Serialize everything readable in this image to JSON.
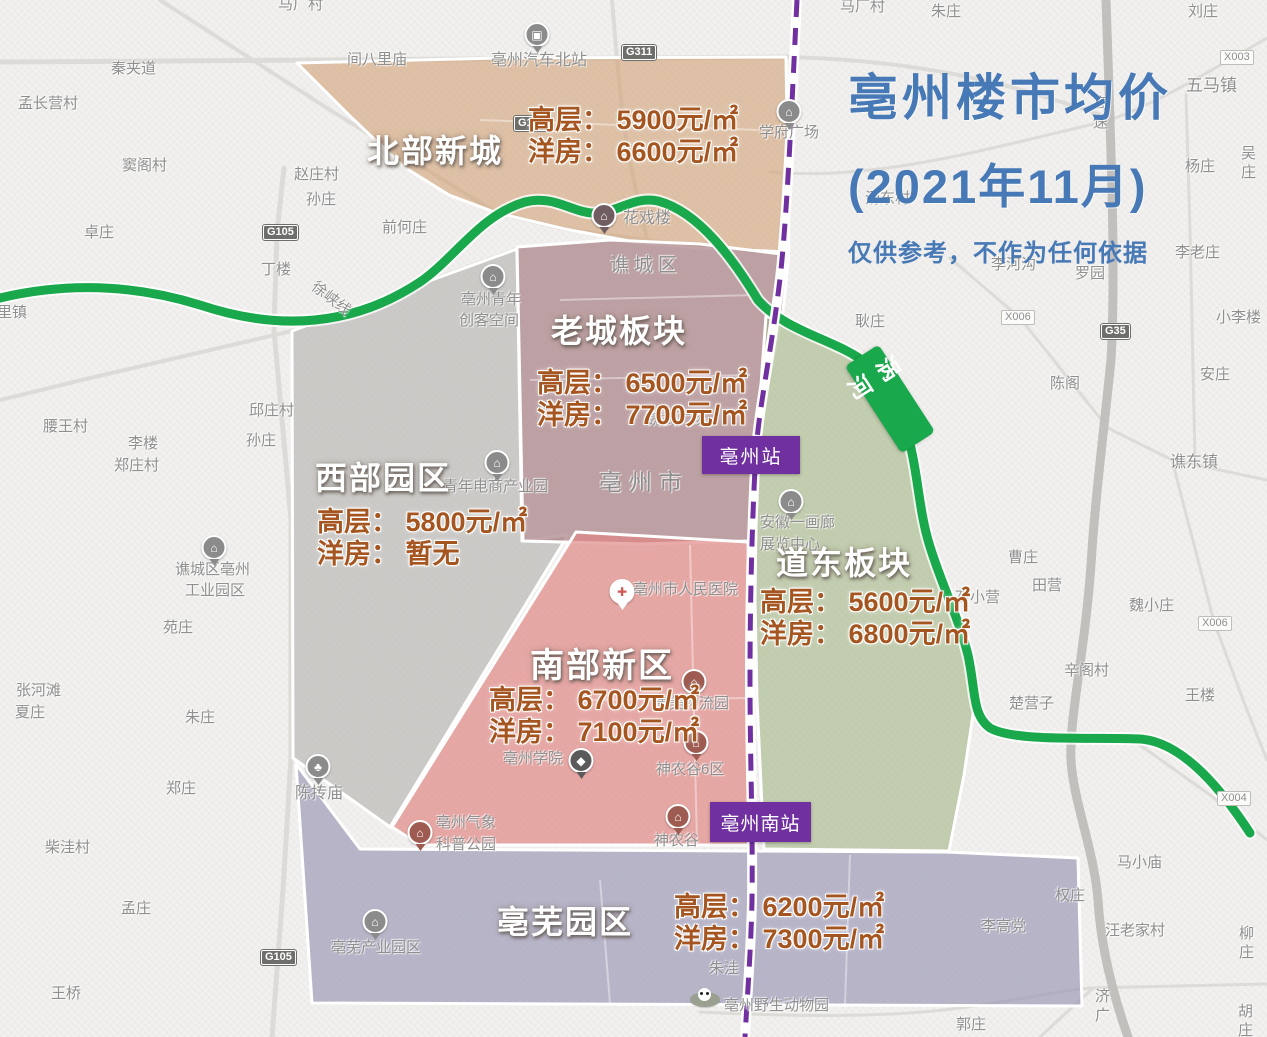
{
  "title": {
    "line1": "亳州楼市均价",
    "line2": "(2021年11月)",
    "disclaimer": "仅供参考，不作为任何依据"
  },
  "price_regions": [
    {
      "name": "北部新城",
      "rows": [
        "高层： 5900元/㎡",
        "洋房： 6600元/㎡"
      ]
    },
    {
      "name": "老城板块",
      "rows": [
        "高层： 6500元/㎡",
        "洋房： 7700元/㎡"
      ]
    },
    {
      "name": "西部园区",
      "rows": [
        "高层： 5800元/㎡",
        "洋房： 暂无"
      ]
    },
    {
      "name": "道东板块",
      "rows": [
        "高层： 5600元/㎡",
        "洋房： 6800元/㎡"
      ]
    },
    {
      "name": "南部新区",
      "rows": [
        "高层： 6700元/㎡",
        "洋房： 7100元/㎡"
      ]
    },
    {
      "name": "亳芜园区",
      "rows": [
        "高层： 6200元/㎡",
        "洋房： 7300元/㎡"
      ]
    }
  ],
  "stations": [
    {
      "label": "亳州站"
    },
    {
      "label": "亳州南站"
    }
  ],
  "river_label": "涡河",
  "colors": {
    "title": "#4679b5",
    "price_text": "#a5551f",
    "river": "#1aa84c",
    "railway": "#7030a0",
    "station_bg": "#7030a0",
    "region_north": "#d2a379",
    "region_old": "#a98287",
    "region_west": "#b2b0ae",
    "region_east": "#a3b685",
    "region_south": "#e08581",
    "region_bowu": "#9a97b5"
  },
  "map_labels": [
    {
      "t": "马厂村",
      "x": 278,
      "y": -4
    },
    {
      "t": "马厂村",
      "x": 840,
      "y": -2
    },
    {
      "t": "孟长营村",
      "x": 18,
      "y": 95
    },
    {
      "t": "秦夹道",
      "x": 111,
      "y": 60
    },
    {
      "t": "窦阁村",
      "x": 122,
      "y": 157
    },
    {
      "t": "卓庄",
      "x": 84,
      "y": 224
    },
    {
      "t": "里镇",
      "x": -3,
      "y": 304
    },
    {
      "t": "丁楼",
      "x": 261,
      "y": 261
    },
    {
      "t": "赵庄村",
      "x": 294,
      "y": 166
    },
    {
      "t": "孙庄",
      "x": 306,
      "y": 191
    },
    {
      "t": "前何庄",
      "x": 382,
      "y": 219
    },
    {
      "t": "间八里庙",
      "x": 347,
      "y": 51
    },
    {
      "t": "亳州汽车北站",
      "x": 491,
      "y": 51,
      "s": 16
    },
    {
      "t": "学府广场",
      "x": 759,
      "y": 124
    },
    {
      "t": "朱庄",
      "x": 931,
      "y": 3
    },
    {
      "t": "刘庄",
      "x": 1188,
      "y": 3
    },
    {
      "t": "五马镇",
      "x": 1186,
      "y": 75,
      "s": 17
    },
    {
      "t": "吴庄",
      "x": 1241,
      "y": 145
    },
    {
      "t": "杨庄",
      "x": 1185,
      "y": 158
    },
    {
      "t": "汤东村",
      "x": 865,
      "y": 190
    },
    {
      "t": "高速",
      "x": 1093,
      "y": 95,
      "vert": 1
    },
    {
      "t": "李老庄",
      "x": 1175,
      "y": 244
    },
    {
      "t": "李河沟",
      "x": 991,
      "y": 256
    },
    {
      "t": "罗园",
      "x": 1075,
      "y": 265
    },
    {
      "t": "小李楼",
      "x": 1216,
      "y": 309
    },
    {
      "t": "陈阁",
      "x": 1050,
      "y": 375
    },
    {
      "t": "安庄",
      "x": 1200,
      "y": 366
    },
    {
      "t": "谯东镇",
      "x": 1170,
      "y": 453,
      "s": 16
    },
    {
      "t": "耿庄",
      "x": 855,
      "y": 313
    },
    {
      "t": "花戏楼",
      "x": 623,
      "y": 209,
      "s": 16
    },
    {
      "t": "谯城区",
      "x": 610,
      "y": 254,
      "s": 19,
      "ls": 5
    },
    {
      "t": "亳州青年",
      "x": 461,
      "y": 291
    },
    {
      "t": "创客空间",
      "x": 459,
      "y": 312
    },
    {
      "t": "徐峡线",
      "x": 308,
      "y": 290,
      "rot": 38
    },
    {
      "t": "邱庄村",
      "x": 249,
      "y": 402
    },
    {
      "t": "孙庄",
      "x": 246,
      "y": 432
    },
    {
      "t": "腰王村",
      "x": 43,
      "y": 418
    },
    {
      "t": "李楼",
      "x": 128,
      "y": 435
    },
    {
      "t": "郑庄村",
      "x": 114,
      "y": 457
    },
    {
      "t": "青年电商产业园",
      "x": 443,
      "y": 478,
      "s": 15
    },
    {
      "t": "亳州市",
      "x": 599,
      "y": 468,
      "s": 23,
      "ls": 7,
      "c": "#8b8b8b"
    },
    {
      "t": "魏武广场",
      "x": 646,
      "y": 411,
      "s": 15
    },
    {
      "t": "安徽一画廊",
      "x": 760,
      "y": 514
    },
    {
      "t": "展览中心",
      "x": 760,
      "y": 536
    },
    {
      "t": "谯城区亳州",
      "x": 175,
      "y": 561
    },
    {
      "t": "工业园区",
      "x": 185,
      "y": 582
    },
    {
      "t": "苑庄",
      "x": 163,
      "y": 619
    },
    {
      "t": "亳州市人民医院",
      "x": 633,
      "y": 581,
      "s": 15
    },
    {
      "t": "康美物流园",
      "x": 654,
      "y": 695
    },
    {
      "t": "亳州学院",
      "x": 503,
      "y": 750
    },
    {
      "t": "神农谷6区",
      "x": 656,
      "y": 761
    },
    {
      "t": "神农谷",
      "x": 654,
      "y": 832
    },
    {
      "t": "亳州气象",
      "x": 436,
      "y": 814
    },
    {
      "t": "科普公园",
      "x": 436,
      "y": 836
    },
    {
      "t": "陈抟庙",
      "x": 295,
      "y": 784,
      "s": 16
    },
    {
      "t": "亳芜产业园区",
      "x": 331,
      "y": 939
    },
    {
      "t": "朱洼",
      "x": 709,
      "y": 960
    },
    {
      "t": "李高党",
      "x": 981,
      "y": 918
    },
    {
      "t": "亳州南站",
      "x": 744,
      "y": 811
    },
    {
      "t": "亳州野生动物园",
      "x": 724,
      "y": 997,
      "s": 15
    },
    {
      "t": "郭庄",
      "x": 956,
      "y": 1016
    },
    {
      "t": "胡庄",
      "x": 1238,
      "y": 1003
    },
    {
      "t": "济广",
      "x": 1095,
      "y": 988,
      "vert": 1
    },
    {
      "t": "张河滩",
      "x": 16,
      "y": 682
    },
    {
      "t": "夏庄",
      "x": 15,
      "y": 704
    },
    {
      "t": "朱庄",
      "x": 185,
      "y": 709
    },
    {
      "t": "郑庄",
      "x": 166,
      "y": 780
    },
    {
      "t": "柴洼村",
      "x": 45,
      "y": 839
    },
    {
      "t": "孟庄",
      "x": 121,
      "y": 900
    },
    {
      "t": "王桥",
      "x": 51,
      "y": 985
    },
    {
      "t": "曹庄",
      "x": 1008,
      "y": 549
    },
    {
      "t": "田营",
      "x": 1032,
      "y": 577
    },
    {
      "t": "石小营",
      "x": 955,
      "y": 589
    },
    {
      "t": "魏小庄",
      "x": 1129,
      "y": 597
    },
    {
      "t": "辛阁村",
      "x": 1064,
      "y": 662
    },
    {
      "t": "王楼",
      "x": 1185,
      "y": 687
    },
    {
      "t": "楚营子",
      "x": 1009,
      "y": 695
    },
    {
      "t": "马小庙",
      "x": 1117,
      "y": 854
    },
    {
      "t": "权庄",
      "x": 1055,
      "y": 887
    },
    {
      "t": "汪老家村",
      "x": 1105,
      "y": 922
    },
    {
      "t": "柳庄",
      "x": 1239,
      "y": 925
    }
  ],
  "road_badges": [
    {
      "t": "G311",
      "x": 622,
      "y": 45
    },
    {
      "t": "G105",
      "x": 263,
      "y": 225
    },
    {
      "t": "G105",
      "x": 514,
      "y": 116
    },
    {
      "t": "G105",
      "x": 261,
      "y": 950
    },
    {
      "t": "G35",
      "x": 1101,
      "y": 324
    },
    {
      "t": "X003",
      "x": 1220,
      "y": 50
    },
    {
      "t": "X006",
      "x": 1001,
      "y": 310
    },
    {
      "t": "X006",
      "x": 1198,
      "y": 616
    },
    {
      "t": "X004",
      "x": 1217,
      "y": 791
    }
  ],
  "pois": [
    {
      "type": "bus-icon",
      "x": 537,
      "y": 22,
      "bg": "#8b8b8b"
    },
    {
      "type": "building-icon",
      "x": 789,
      "y": 99,
      "bg": "#8b8b8b"
    },
    {
      "type": "building-icon",
      "x": 604,
      "y": 203,
      "bg": "#6f5d62"
    },
    {
      "type": "building-icon",
      "x": 493,
      "y": 264,
      "bg": "#8b8b8b"
    },
    {
      "type": "building-icon",
      "x": 497,
      "y": 450,
      "bg": "#8b8b8b"
    },
    {
      "type": "building-icon",
      "x": 214,
      "y": 535,
      "bg": "#8b8b8b"
    },
    {
      "type": "building-icon",
      "x": 791,
      "y": 489,
      "bg": "#8b8b8b"
    },
    {
      "type": "hospital-icon",
      "x": 622,
      "y": 579,
      "bg": "#ffffff",
      "fg": "#d05a55"
    },
    {
      "type": "building-icon",
      "x": 694,
      "y": 669,
      "bg": "#9e5b51"
    },
    {
      "type": "building-icon",
      "x": 696,
      "y": 730,
      "bg": "#9e5b51"
    },
    {
      "type": "cap-icon",
      "x": 581,
      "y": 748,
      "bg": "#5a5a5a"
    },
    {
      "type": "building-icon",
      "x": 678,
      "y": 804,
      "bg": "#9e5b51"
    },
    {
      "type": "building-icon",
      "x": 420,
      "y": 820,
      "bg": "#9e5b51"
    },
    {
      "type": "tree-icon",
      "x": 318,
      "y": 754,
      "bg": "#8b8b8b"
    },
    {
      "type": "building-icon",
      "x": 375,
      "y": 909,
      "bg": "#8b8b8b"
    },
    {
      "type": "panda-icon",
      "x": 705,
      "y": 992
    }
  ]
}
